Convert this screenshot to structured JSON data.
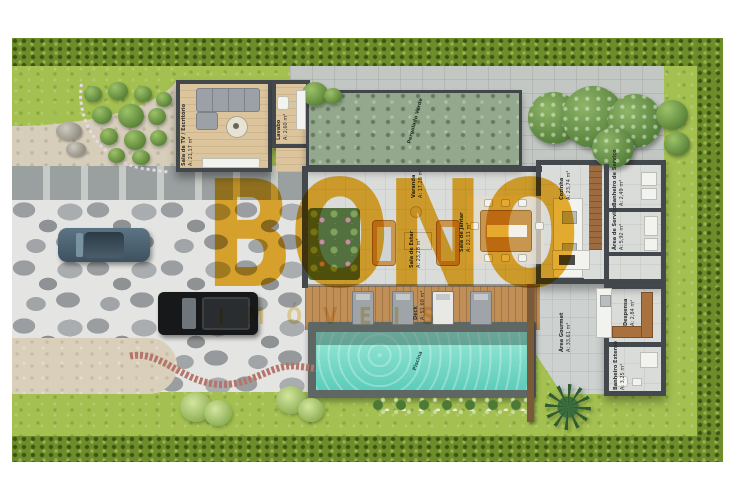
{
  "meta": {
    "description": "Top-down architectural site plan render of a single-storey house with garden, driveway, pool and deck",
    "palette": {
      "watermark_yellow": "#EEAC20",
      "hedge_green": "#6D8C2A",
      "grass_green": "#A3C050",
      "pool_turquoise": "#5DCCBA",
      "deck_wood": "#C08E57",
      "wall_dark": "#43484D",
      "stone_gray": "#9B9EA0"
    }
  },
  "watermark": {
    "brand": "BONO",
    "subtitle": "IMÓVEIS"
  },
  "rooms": {
    "sala_tv": {
      "label": "Sala de TV / Escritório",
      "area": "A: 21,17 m²"
    },
    "lavabo": {
      "label": "Lavabo",
      "area": "A: 2,60 m²"
    },
    "pergolado": {
      "label": "Pergolado Verde",
      "area": ""
    },
    "varanda": {
      "label": "Varanda",
      "area": "A: 17,28 m²"
    },
    "cozinha": {
      "label": "Cozinha",
      "area": "A: 23,74 m²"
    },
    "banheiro_servico": {
      "label": "Banheiro de Serviço",
      "area": "A: 2,49 m²"
    },
    "area_servico": {
      "label": "Área de Serviço",
      "area": "A: 5,92 m²"
    },
    "sala_estar": {
      "label": "Sala de Estar",
      "area": "A: 23,28 m²"
    },
    "sala_jantar": {
      "label": "Sala de Jantar",
      "area": "A: 22,11 m²"
    },
    "deck": {
      "label": "Deck",
      "area": "A: 51,68 m²"
    },
    "piscina": {
      "label": "Piscina",
      "area": ""
    },
    "area_gourmet": {
      "label": "Área Gourmet",
      "area": "A: 33,61 m²"
    },
    "despensa": {
      "label": "Despensa",
      "area": "A: 2,84 m²"
    },
    "banheiro_externo": {
      "label": "Banheiro Externo",
      "area": "A: 3,25 m²"
    }
  }
}
